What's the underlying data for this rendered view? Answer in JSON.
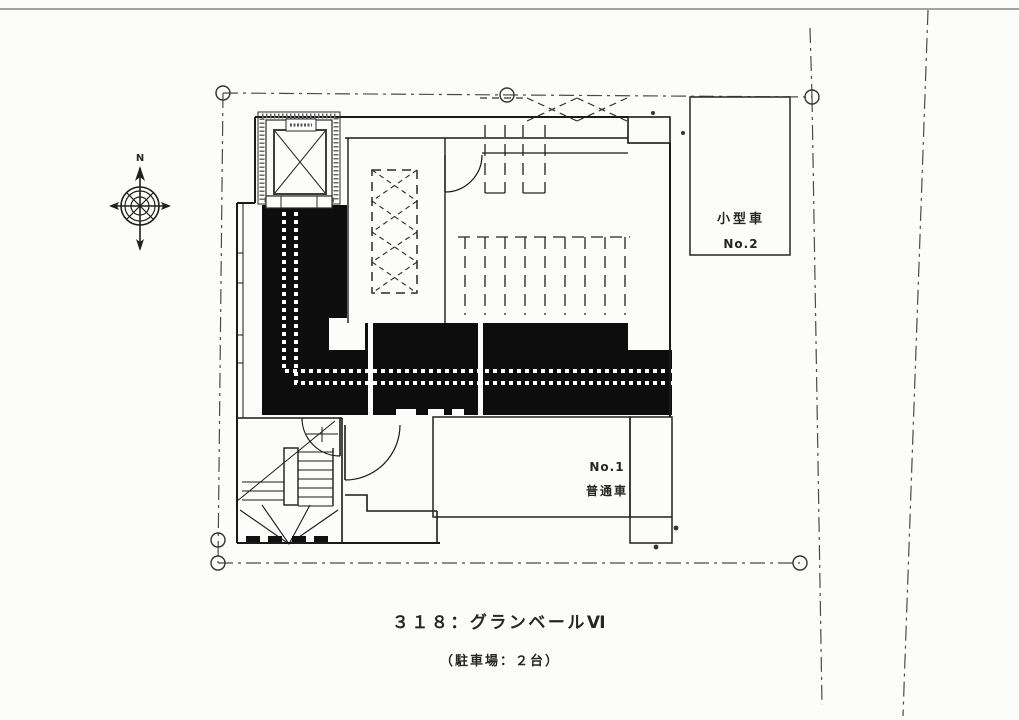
{
  "drawing": {
    "title": "３１８：グランベールⅥ",
    "subtitle": "（駐車場：２台）",
    "compass_label": "N",
    "parking_space_1": {
      "number": "No.1",
      "type": "普通車"
    },
    "parking_space_2": {
      "type": "小型車",
      "number": "No.2"
    }
  },
  "colors": {
    "ink": "#2a2a2a",
    "walkway_fill": "#0d0d0d",
    "paper": "#fcfcfa"
  }
}
